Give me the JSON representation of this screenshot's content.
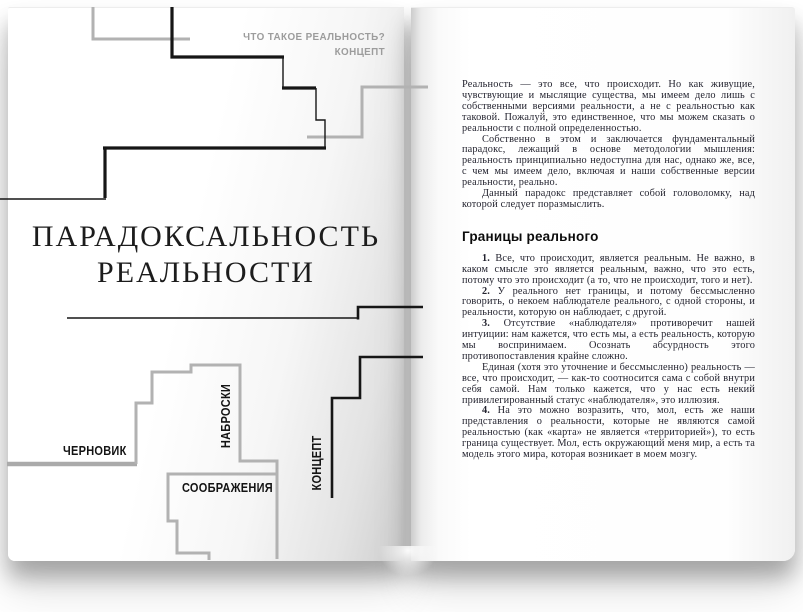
{
  "left_page": {
    "header_line1": "ЧТО ТАКОЕ РЕАЛЬНОСТЬ?",
    "header_line2": "КОНЦЕПТ",
    "title_line1": "ПАРАДОКСАЛЬНОСТЬ",
    "title_line2": "РЕАЛЬНОСТИ",
    "label_draft": "ЧЕРНОВИК",
    "label_sketches": "НАБРОСКИ",
    "label_considerations": "СООБРАЖЕНИЯ",
    "label_concept": "КОНЦЕПТ"
  },
  "right_page": {
    "intro": [
      "Реальность — это все, что происходит. Но как живущие, чувствующие и мыслящие существа, мы имеем дело лишь с собственными версиями реальности, а не с реальностью как таковой. Пожалуй, это единственное, что мы можем сказать о реальности с полной определенностью.",
      "Собственно в этом и заключается фундаментальный парадокс, лежащий в основе методологии мышления: реальность принципиально недоступна для нас, однако же, все, с чем мы имеем дело, включая и наши собственные версии реальности, реально.",
      "Данный парадокс представляет собой головоломку, над которой следует поразмыслить."
    ],
    "section_heading": "Границы реального",
    "items": [
      {
        "num": "1.",
        "text": " Все, что происходит, является реальным. Не важно, в каком смысле это является реальным, важно, что это есть, потому что это происходит (а то, что не происходит, того и нет)."
      },
      {
        "num": "2.",
        "text": " У реального нет границы, и потому бессмысленно говорить, о некоем наблюдателе реального, с одной стороны, и реальности, которую он наблюдает, с другой."
      },
      {
        "num": "3.",
        "text": " Отсутствие «наблюдателя» противоречит нашей интуиции: нам кажется, что есть мы, а есть реальность, которую мы воспринимаем. Осознать абсурдность этого противопоставления крайне сложно."
      },
      {
        "num": "",
        "text": "Единая (хотя это уточнение и бессмысленно) реальность — все, что происходит, — как-то соотносится сама с собой внутри себя самой. Нам только кажется, что у нас есть некий привилегированный статус «наблюдателя», это иллюзия."
      },
      {
        "num": "4.",
        "text": " На это можно возразить, что, мол, есть же наши представления о реальности, которые не являются самой реальностью (как «карта» не является «территорией»), то есть граница существует. Мол, есть окружающий меня мир, а есть та модель этого мира, которая возникает в моем мозгу."
      }
    ]
  },
  "colors": {
    "line_black": "#161616",
    "line_gray": "#b2b2b2",
    "header_gray": "#9c9c9c",
    "text_ink": "#23232f"
  }
}
